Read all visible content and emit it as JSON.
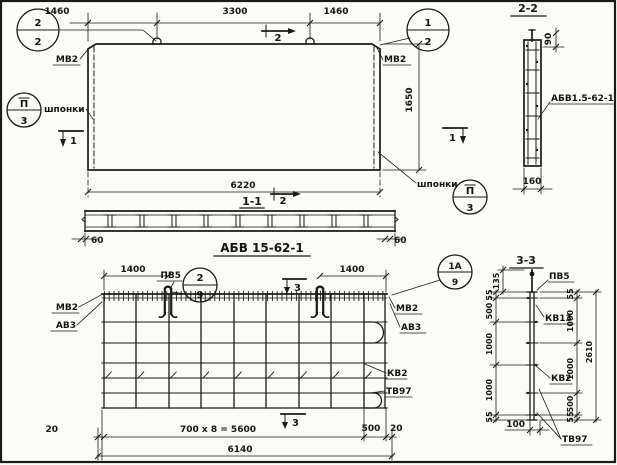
{
  "plan": {
    "dim_seg_1": "1460",
    "dim_seg_2": "3300",
    "dim_seg_3": "1460",
    "dim_height": "1650",
    "dim_total": "6220",
    "callout_tl": {
      "num": "2",
      "sheet": "2"
    },
    "callout_tr": {
      "num": "1",
      "sheet": "2"
    },
    "callout_key_left": {
      "num": "П",
      "sheet": "3"
    },
    "callout_key_right": {
      "num": "П",
      "sheet": "3"
    },
    "label_mv2_left": "МВ2",
    "label_mv2_right": "МВ2",
    "label_keys_left": "шпонки",
    "label_keys_right": "шпонки",
    "mark_1_left": "1",
    "mark_1_right": "1",
    "mark_2": "2"
  },
  "section_1_1": {
    "title": "1-1",
    "mark_2": "2",
    "dim_end_left": "60",
    "dim_end_right": "60"
  },
  "mesh": {
    "title": "АБВ 15-62-1",
    "label_pv5": "ПВ5",
    "callout_loop": {
      "num": "2",
      "sheet": "9"
    },
    "callout_corner": {
      "num": "1А",
      "sheet": "9"
    },
    "dim_loop_left": "1400",
    "dim_loop_right": "1400",
    "label_mv2_left": "МВ2",
    "label_av3_left": "АВ3",
    "label_mv2_right": "МВ2",
    "label_av3_right": "АВ3",
    "label_kv2": "КВ2",
    "label_tv97": "ТВ97",
    "mark_3_top": "3",
    "mark_3_bottom": "3",
    "dim_20_left": "20",
    "dim_spacing": "700 x 8 = 5600",
    "dim_500": "500",
    "dim_20_right": "20",
    "dim_total": "6140"
  },
  "section_2_2": {
    "title": "2-2",
    "dim_top": "90",
    "label_mesh": "АБВ1.5-62-1",
    "dim_width": "160"
  },
  "section_3_3": {
    "title": "3-3",
    "label_pv5": "ПВ5",
    "label_kv13": "КВ13",
    "label_kv2": "КВ2",
    "label_tv97": "ТВ97",
    "dim_135": "135",
    "dims_left": [
      "55",
      "500",
      "1000",
      "1000",
      "55"
    ],
    "dims_right": [
      "55",
      "1000",
      "1000",
      "500",
      "55"
    ],
    "dim_total": "2610",
    "dim_100": "100"
  }
}
